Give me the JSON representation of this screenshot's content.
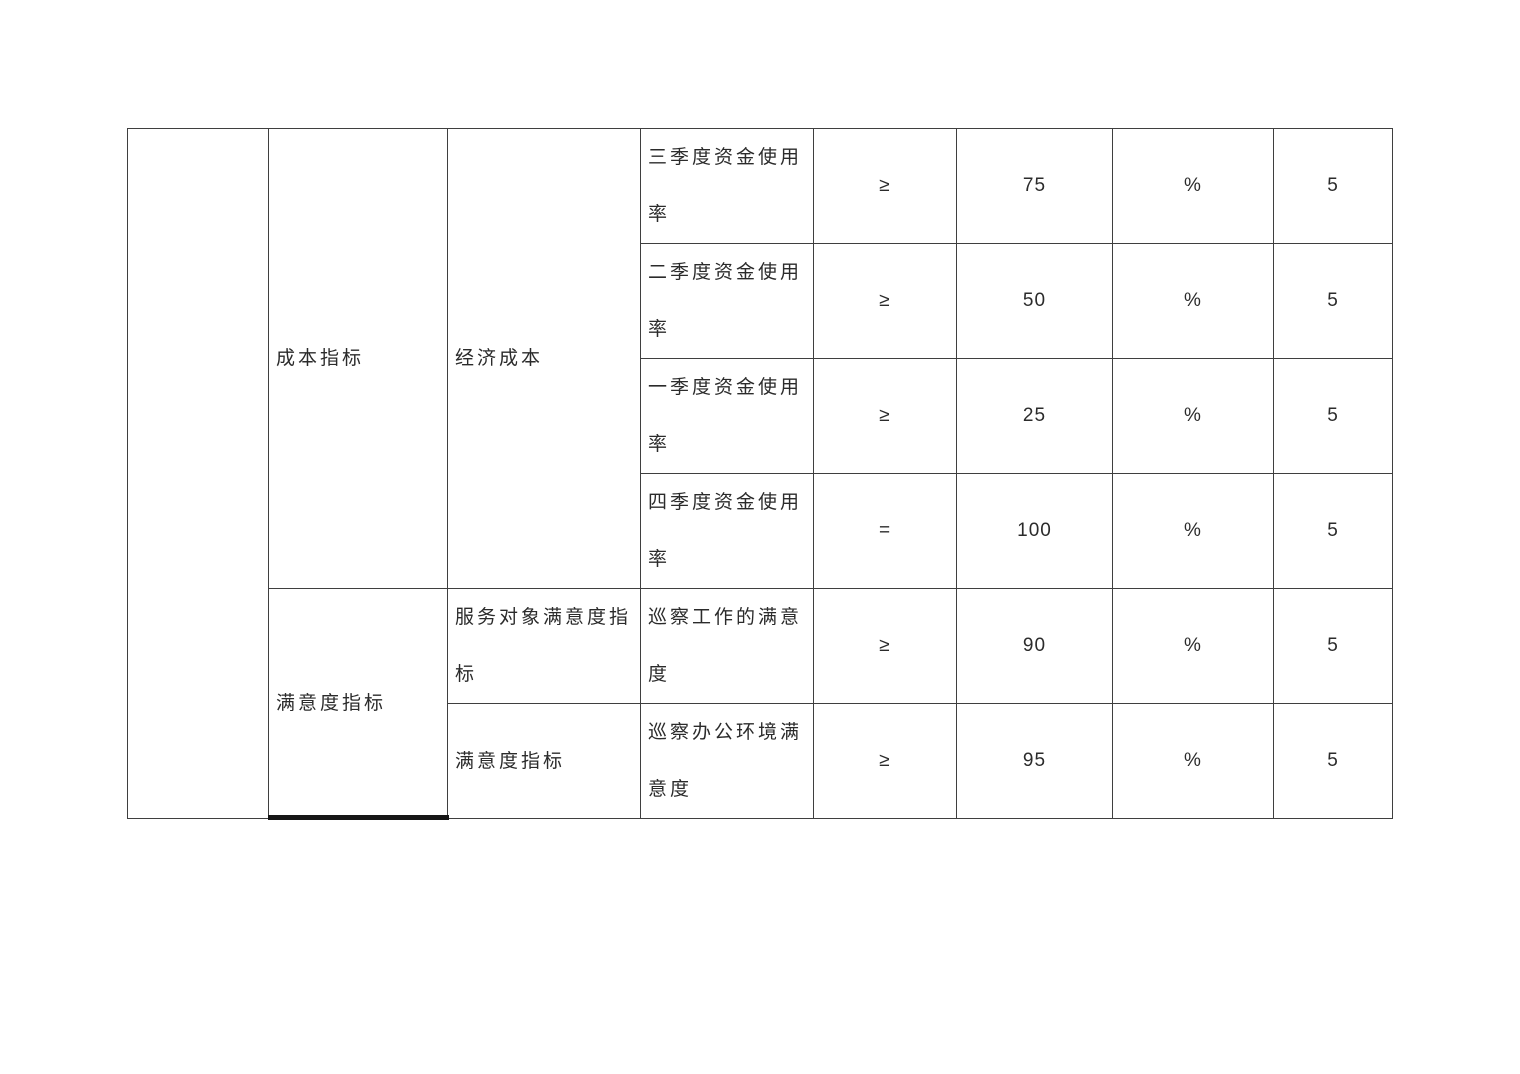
{
  "colors": {
    "page_background": "#ffffff",
    "table_border": "#3f3f3f",
    "text": "#2b2b2b",
    "page_break_line": "#161616"
  },
  "table": {
    "blank_left_cell": "",
    "groups": [
      {
        "category": "成本指标",
        "subcategory": "经济成本",
        "rows": [
          {
            "indicator": "三季度资金使用率",
            "operator": "≥",
            "value": "75",
            "unit": "%",
            "score": "5"
          },
          {
            "indicator": "二季度资金使用率",
            "operator": "≥",
            "value": "50",
            "unit": "%",
            "score": "5"
          },
          {
            "indicator": "一季度资金使用率",
            "operator": "≥",
            "value": "25",
            "unit": "%",
            "score": "5"
          },
          {
            "indicator": "四季度资金使用率",
            "operator": "=",
            "value": "100",
            "unit": "%",
            "score": "5"
          }
        ]
      },
      {
        "category": "满意度指标",
        "rows": [
          {
            "subcategory": "服务对象满意度指标",
            "indicator": "巡察工作的满意度",
            "operator": "≥",
            "value": "90",
            "unit": "%",
            "score": "5"
          },
          {
            "subcategory": "满意度指标",
            "indicator": "巡察办公环境满意度",
            "operator": "≥",
            "value": "95",
            "unit": "%",
            "score": "5"
          }
        ]
      }
    ]
  }
}
